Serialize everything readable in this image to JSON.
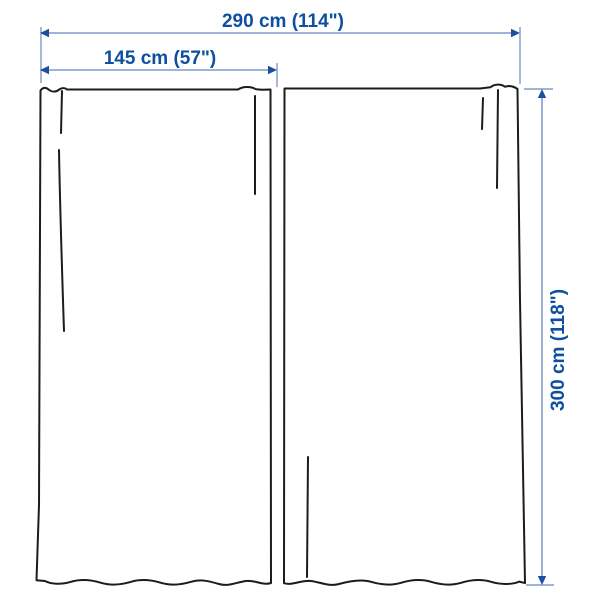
{
  "dimensions": {
    "total_width": {
      "label": "290 cm (114\")"
    },
    "panel_width": {
      "label": "145 cm (57\")"
    },
    "height": {
      "label": "300 cm (118\")"
    }
  },
  "colors": {
    "outline": "#1c1c1c",
    "dim_line": "#7e9bcb",
    "dim_arrow": "#1c4f9f",
    "dim_text": "#0d4fa0"
  }
}
